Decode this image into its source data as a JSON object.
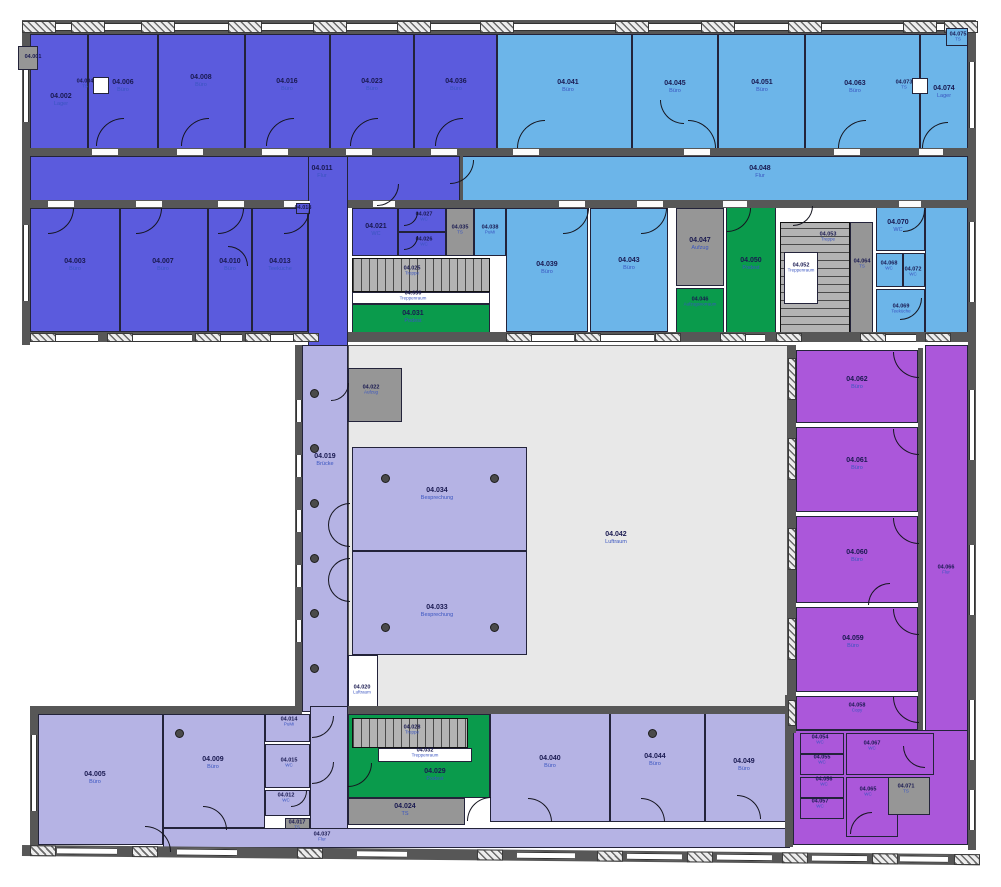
{
  "plan": {
    "kind": "floor-plan",
    "level_prefix": "04",
    "colors": {
      "office_indigo": "#5b5bdd",
      "office_blue": "#6cb5e9",
      "office_lavender": "#b5b3e4",
      "office_magenta": "#ab57da",
      "landing_green": "#0a9b4c",
      "shaft_gray": "#969696",
      "void_gray": "#e8e8e8",
      "wall_gray": "#575757"
    }
  },
  "rooms": [
    {
      "id": "04.001",
      "use": "",
      "f": "gry",
      "r": [
        18,
        46,
        20,
        24
      ],
      "l": [
        33,
        57
      ],
      "s": 1,
      "top": 1
    },
    {
      "id": "04.002",
      "use": "Lager",
      "f": "ind",
      "r": [
        30,
        34,
        58,
        118
      ],
      "l": [
        61,
        100
      ]
    },
    {
      "id": "04.006",
      "use": "Büro",
      "f": "ind",
      "r": [
        88,
        34,
        70,
        118
      ],
      "l": [
        123,
        86
      ]
    },
    {
      "id": "04.008",
      "use": "Büro",
      "f": "ind",
      "r": [
        158,
        34,
        87,
        118
      ],
      "l": [
        201,
        81
      ]
    },
    {
      "id": "04.016",
      "use": "Büro",
      "f": "ind",
      "r": [
        245,
        34,
        85,
        118
      ],
      "l": [
        287,
        85
      ]
    },
    {
      "id": "04.023",
      "use": "Büro",
      "f": "ind",
      "r": [
        330,
        34,
        84,
        118
      ],
      "l": [
        372,
        85
      ]
    },
    {
      "id": "04.036",
      "use": "Büro",
      "f": "ind",
      "r": [
        414,
        34,
        83,
        118
      ],
      "l": [
        456,
        85
      ]
    },
    {
      "id": "04.004",
      "use": "TS",
      "f": "wht",
      "r": [
        93,
        77,
        16,
        17
      ],
      "l": [
        85,
        84
      ],
      "s": 1,
      "top": 1
    },
    {
      "id": "04.041",
      "use": "Büro",
      "f": "blu",
      "r": [
        497,
        34,
        135,
        118
      ],
      "l": [
        568,
        86
      ]
    },
    {
      "id": "04.045",
      "use": "Büro",
      "f": "blu",
      "r": [
        632,
        34,
        86,
        118
      ],
      "l": [
        675,
        87
      ]
    },
    {
      "id": "04.051",
      "use": "Büro",
      "f": "blu",
      "r": [
        718,
        34,
        87,
        118
      ],
      "l": [
        762,
        86
      ]
    },
    {
      "id": "04.063",
      "use": "Büro",
      "f": "blu",
      "r": [
        805,
        34,
        115,
        118
      ],
      "l": [
        855,
        87
      ]
    },
    {
      "id": "04.074",
      "use": "Lager",
      "f": "blu",
      "r": [
        920,
        34,
        48,
        118
      ],
      "l": [
        944,
        92
      ]
    },
    {
      "id": "04.073",
      "use": "TS",
      "f": "wht",
      "r": [
        912,
        78,
        16,
        16
      ],
      "l": [
        904,
        85
      ],
      "s": 1,
      "top": 1
    },
    {
      "id": "04.075",
      "use": "TS",
      "f": "blu",
      "r": [
        946,
        28,
        22,
        18
      ],
      "l": [
        958,
        37
      ],
      "s": 1,
      "top": 1
    },
    {
      "id": "04.011",
      "use": "Flur",
      "f": "ind",
      "r": [
        30,
        156,
        430,
        46
      ],
      "l": [
        322,
        172
      ]
    },
    {
      "id": "",
      "use": "",
      "f": "ind",
      "r": [
        308,
        156,
        40,
        192
      ]
    },
    {
      "id": "04.048",
      "use": "Flur",
      "f": "blu",
      "r": [
        460,
        156,
        508,
        46
      ],
      "l": [
        760,
        172
      ]
    },
    {
      "id": "04.003",
      "use": "Büro",
      "f": "ind",
      "r": [
        30,
        208,
        90,
        124
      ],
      "l": [
        75,
        265
      ]
    },
    {
      "id": "04.007",
      "use": "Büro",
      "f": "ind",
      "r": [
        120,
        208,
        88,
        124
      ],
      "l": [
        163,
        265
      ]
    },
    {
      "id": "04.010",
      "use": "Büro",
      "f": "ind",
      "r": [
        208,
        208,
        44,
        124
      ],
      "l": [
        230,
        265
      ]
    },
    {
      "id": "04.013",
      "use": "Teeküche",
      "f": "ind",
      "r": [
        252,
        208,
        56,
        124
      ],
      "l": [
        280,
        265
      ]
    },
    {
      "id": "04.018",
      "use": "",
      "f": "ind",
      "r": [
        296,
        203,
        14,
        11
      ],
      "l": [
        303,
        208
      ],
      "s": 1,
      "top": 1
    },
    {
      "id": "04.021",
      "use": "WC",
      "f": "ind",
      "r": [
        352,
        208,
        46,
        48
      ],
      "l": [
        376,
        230
      ]
    },
    {
      "id": "04.027",
      "use": "WC",
      "f": "ind",
      "r": [
        398,
        208,
        48,
        24
      ],
      "l": [
        424,
        217
      ],
      "s": 1
    },
    {
      "id": "04.026",
      "use": "WC",
      "f": "ind",
      "r": [
        398,
        232,
        48,
        24
      ],
      "l": [
        424,
        242
      ],
      "s": 1
    },
    {
      "id": "04.035",
      "use": "TS",
      "f": "gry",
      "r": [
        446,
        208,
        28,
        48
      ],
      "l": [
        460,
        230
      ],
      "s": 1
    },
    {
      "id": "04.038",
      "use": "PuMi",
      "f": "blu",
      "r": [
        474,
        208,
        32,
        48
      ],
      "l": [
        490,
        230
      ],
      "s": 1
    },
    {
      "id": "04.025",
      "use": "Treppe",
      "f": "stv",
      "r": [
        352,
        258,
        138,
        34
      ],
      "l": [
        412,
        271
      ],
      "s": 1
    },
    {
      "id": "04.030",
      "use": "Treppenraum",
      "f": "wht",
      "r": [
        352,
        292,
        138,
        12
      ],
      "l": [
        413,
        296
      ],
      "s": 1
    },
    {
      "id": "04.031",
      "use": "Podest",
      "f": "grn",
      "r": [
        352,
        304,
        138,
        30
      ],
      "l": [
        413,
        317
      ]
    },
    {
      "id": "04.039",
      "use": "Büro",
      "f": "blu",
      "r": [
        506,
        208,
        82,
        124
      ],
      "l": [
        547,
        268
      ]
    },
    {
      "id": "04.043",
      "use": "Büro",
      "f": "blu",
      "r": [
        590,
        208,
        78,
        124
      ],
      "l": [
        629,
        264
      ]
    },
    {
      "id": "04.047",
      "use": "Aufzug",
      "f": "gry",
      "r": [
        676,
        208,
        48,
        78
      ],
      "l": [
        700,
        244
      ]
    },
    {
      "id": "04.046",
      "use": "Aufzugsvorraum",
      "f": "grn",
      "r": [
        676,
        288,
        48,
        48
      ],
      "l": [
        700,
        302
      ],
      "s": 1
    },
    {
      "id": "04.050",
      "use": "Podest",
      "f": "grn",
      "r": [
        726,
        205,
        50,
        133
      ],
      "l": [
        751,
        264
      ]
    },
    {
      "id": "04.053",
      "use": "Treppe",
      "f": "sth",
      "r": [
        780,
        222,
        70,
        112
      ],
      "l": [
        828,
        237
      ],
      "s": 1
    },
    {
      "id": "04.052",
      "use": "Treppenraum",
      "f": "wht",
      "r": [
        784,
        252,
        34,
        52
      ],
      "l": [
        801,
        268
      ],
      "s": 1
    },
    {
      "id": "04.064",
      "use": "TS",
      "f": "gry",
      "r": [
        850,
        222,
        23,
        112
      ],
      "l": [
        862,
        264
      ],
      "s": 1
    },
    {
      "id": "04.070",
      "use": "WC",
      "f": "blu",
      "r": [
        876,
        205,
        49,
        46
      ],
      "l": [
        898,
        226
      ]
    },
    {
      "id": "04.068",
      "use": "WC",
      "f": "blu",
      "r": [
        876,
        253,
        27,
        34
      ],
      "l": [
        889,
        266
      ],
      "s": 1
    },
    {
      "id": "04.072",
      "use": "WC",
      "f": "blu",
      "r": [
        903,
        253,
        22,
        34
      ],
      "l": [
        913,
        272
      ],
      "s": 1
    },
    {
      "id": "04.069",
      "use": "Teeküche",
      "f": "blu",
      "r": [
        876,
        289,
        49,
        47
      ],
      "l": [
        901,
        309
      ],
      "s": 1
    },
    {
      "id": "",
      "use": "",
      "f": "blu",
      "r": [
        925,
        205,
        43,
        131
      ]
    },
    {
      "id": "04.019",
      "use": "Brücke",
      "f": "lav",
      "r": [
        302,
        345,
        46,
        367
      ],
      "l": [
        325,
        460
      ]
    },
    {
      "id": "04.042",
      "use": "Luftraum",
      "f": "luf",
      "r": [
        348,
        345,
        440,
        367
      ],
      "l": [
        616,
        538
      ]
    },
    {
      "id": "04.022",
      "use": "Aufzug",
      "f": "gry",
      "r": [
        348,
        368,
        54,
        54
      ],
      "l": [
        371,
        390
      ],
      "s": 1
    },
    {
      "id": "04.034",
      "use": "Besprechung",
      "f": "lav",
      "r": [
        352,
        447,
        175,
        104
      ],
      "l": [
        437,
        494
      ]
    },
    {
      "id": "04.033",
      "use": "Besprechung",
      "f": "lav",
      "r": [
        352,
        551,
        175,
        104
      ],
      "l": [
        437,
        611
      ]
    },
    {
      "id": "04.020",
      "use": "Luftraum",
      "f": "wht",
      "r": [
        348,
        655,
        30,
        57
      ],
      "l": [
        362,
        690
      ],
      "s": 1
    },
    {
      "id": "04.062",
      "use": "Büro",
      "f": "mag",
      "r": [
        796,
        350,
        122,
        73
      ],
      "l": [
        857,
        383
      ]
    },
    {
      "id": "04.061",
      "use": "Büro",
      "f": "mag",
      "r": [
        796,
        427,
        122,
        85
      ],
      "l": [
        857,
        464
      ]
    },
    {
      "id": "04.060",
      "use": "Büro",
      "f": "mag",
      "r": [
        796,
        516,
        122,
        87
      ],
      "l": [
        857,
        556
      ]
    },
    {
      "id": "04.059",
      "use": "Büro",
      "f": "mag",
      "r": [
        796,
        607,
        122,
        85
      ],
      "l": [
        853,
        642
      ]
    },
    {
      "id": "04.058",
      "use": "Copy",
      "f": "mag",
      "r": [
        796,
        696,
        122,
        34
      ],
      "l": [
        857,
        708
      ],
      "s": 1
    },
    {
      "id": "04.066",
      "use": "Flur",
      "f": "mag",
      "r": [
        925,
        345,
        43,
        500
      ],
      "l": [
        946,
        570
      ],
      "s": 1
    },
    {
      "id": "",
      "use": "",
      "f": "mag",
      "r": [
        793,
        730,
        175,
        115
      ]
    },
    {
      "id": "04.005",
      "use": "Büro",
      "f": "lav",
      "r": [
        38,
        714,
        125,
        131
      ],
      "l": [
        95,
        778
      ]
    },
    {
      "id": "04.009",
      "use": "Büro",
      "f": "lav",
      "r": [
        163,
        714,
        102,
        114
      ],
      "l": [
        213,
        763
      ]
    },
    {
      "id": "04.014",
      "use": "PuMi",
      "f": "lav",
      "r": [
        265,
        714,
        45,
        28
      ],
      "l": [
        289,
        722
      ],
      "s": 1
    },
    {
      "id": "04.015",
      "use": "WC",
      "f": "lav",
      "r": [
        265,
        744,
        45,
        44
      ],
      "l": [
        289,
        763
      ],
      "s": 1
    },
    {
      "id": "04.012",
      "use": "WC",
      "f": "lav",
      "r": [
        265,
        790,
        45,
        26
      ],
      "l": [
        286,
        798
      ],
      "s": 1
    },
    {
      "id": "04.017",
      "use": "TS",
      "f": "gry",
      "r": [
        285,
        818,
        25,
        26
      ],
      "l": [
        297,
        825
      ],
      "s": 1
    },
    {
      "id": "",
      "use": "",
      "f": "lav",
      "r": [
        310,
        706,
        38,
        124
      ]
    },
    {
      "id": "04.037",
      "use": "Flur",
      "f": "lav",
      "r": [
        163,
        828,
        627,
        20
      ],
      "l": [
        322,
        837
      ],
      "s": 1
    },
    {
      "id": "04.029",
      "use": "Podest",
      "f": "grn",
      "r": [
        348,
        714,
        142,
        84
      ],
      "l": [
        435,
        775
      ]
    },
    {
      "id": "04.028",
      "use": "Treppe",
      "f": "stv",
      "r": [
        352,
        718,
        116,
        30
      ],
      "l": [
        412,
        730
      ],
      "s": 1
    },
    {
      "id": "04.032",
      "use": "Treppenraum",
      "f": "wht",
      "r": [
        378,
        748,
        94,
        14
      ],
      "l": [
        425,
        753
      ],
      "s": 1
    },
    {
      "id": "04.024",
      "use": "TS",
      "f": "gry",
      "r": [
        348,
        798,
        117,
        27
      ],
      "l": [
        405,
        810
      ]
    },
    {
      "id": "04.040",
      "use": "Büro",
      "f": "lav",
      "r": [
        490,
        710,
        120,
        112
      ],
      "l": [
        550,
        762
      ]
    },
    {
      "id": "04.044",
      "use": "Büro",
      "f": "lav",
      "r": [
        610,
        710,
        95,
        112
      ],
      "l": [
        655,
        760
      ]
    },
    {
      "id": "04.049",
      "use": "Büro",
      "f": "lav",
      "r": [
        705,
        710,
        83,
        112
      ],
      "l": [
        744,
        765
      ]
    },
    {
      "id": "04.054",
      "use": "WC",
      "f": "mag",
      "r": [
        800,
        733,
        44,
        21
      ],
      "l": [
        820,
        740
      ],
      "s": 1
    },
    {
      "id": "04.055",
      "use": "WC",
      "f": "mag",
      "r": [
        800,
        754,
        44,
        21
      ],
      "l": [
        822,
        760
      ],
      "s": 1
    },
    {
      "id": "04.056",
      "use": "WC",
      "f": "mag",
      "r": [
        800,
        777,
        44,
        21
      ],
      "l": [
        824,
        782
      ],
      "s": 1
    },
    {
      "id": "04.057",
      "use": "WC",
      "f": "mag",
      "r": [
        800,
        798,
        44,
        21
      ],
      "l": [
        820,
        804
      ],
      "s": 1
    },
    {
      "id": "04.067",
      "use": "WC",
      "f": "mag",
      "r": [
        846,
        733,
        88,
        42
      ],
      "l": [
        872,
        746
      ],
      "s": 1
    },
    {
      "id": "04.065",
      "use": "WC",
      "f": "mag",
      "r": [
        846,
        777,
        52,
        60
      ],
      "l": [
        868,
        792
      ],
      "s": 1
    },
    {
      "id": "04.071",
      "use": "TS",
      "f": "gry",
      "r": [
        888,
        777,
        42,
        38
      ],
      "l": [
        906,
        789
      ],
      "s": 1
    }
  ]
}
